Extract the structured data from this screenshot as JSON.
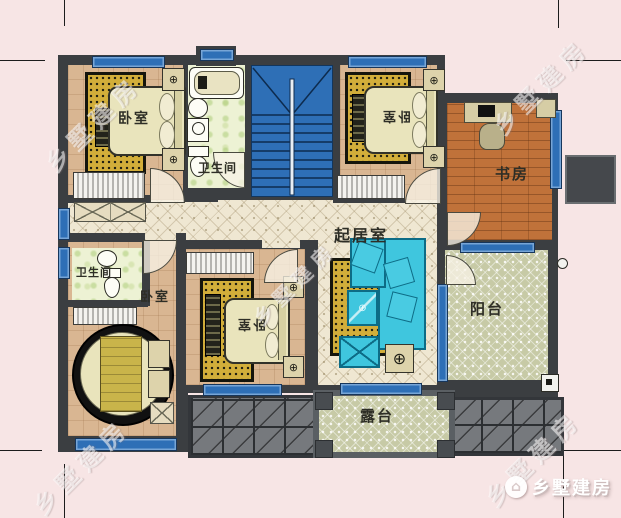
{
  "brand": {
    "watermark": "乡墅建房",
    "logo_text": "乡墅建房",
    "logo_icon": "house-icon"
  },
  "rooms": {
    "bedroom_top_left": {
      "label": "卧室"
    },
    "bath_top": {
      "label": "卫生间"
    },
    "bedroom_top_right": {
      "label": "卧室"
    },
    "study": {
      "label": "书房"
    },
    "living_room": {
      "label": "起居室"
    },
    "bath_left": {
      "label": "卫生间"
    },
    "bedroom_left": {
      "label": "卧室"
    },
    "bedroom_bottom": {
      "label": "卧室"
    },
    "balcony": {
      "label": "阳台"
    },
    "terrace": {
      "label": "露台"
    }
  },
  "icons": {
    "lamp": "⊕",
    "plant": "⊕",
    "house": "⌂"
  },
  "colors": {
    "background": "#f7e5e5",
    "wall": "#3b3e41",
    "stairs_blue": "#2e6fb6",
    "window_blue": "#2e6fb6",
    "bedroom_floor": "#d9b692",
    "hall_tile": "#efe7d2",
    "bath_tile": "#edf2d4",
    "study_wood": "#c0723a",
    "outdoor_tile": "#c7caa6",
    "roof_gray": "#76797d",
    "rug_gold": "#d2ae3a",
    "sofa_cyan": "#3fc6de",
    "bed_khaki": "#e9e4bc"
  }
}
